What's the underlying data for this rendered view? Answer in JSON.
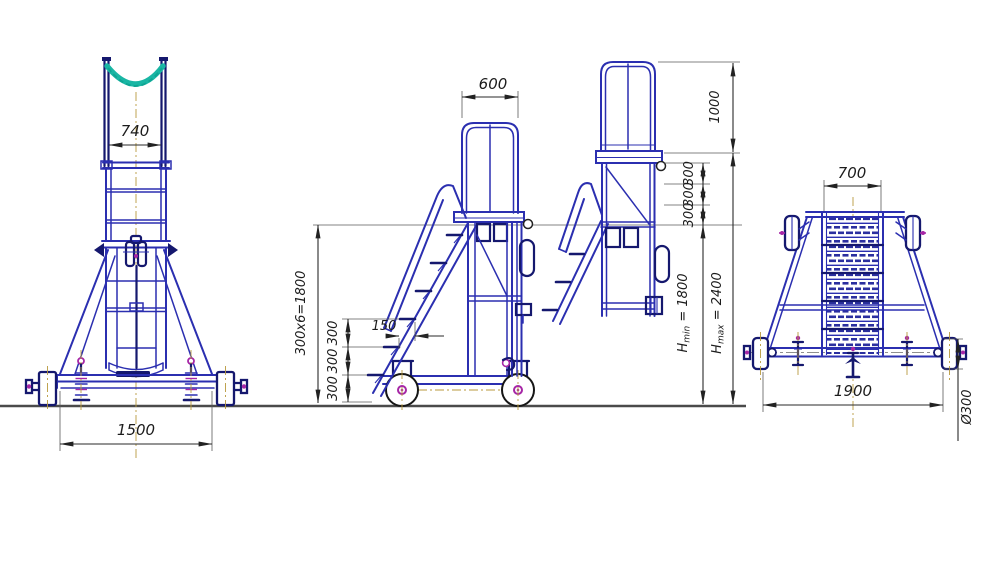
{
  "meta": {
    "description": "GOST-style dimensioned engineering drawing, three views of a mobile adjustable-height platform step-ladder with top cradle"
  },
  "colors": {
    "line_blue": "#2b2fb0",
    "line_navy": "#15186e",
    "accent_teal": "#19b6a4",
    "hub_magenta": "#a626a6",
    "centerline_olive": "#b99a3e",
    "dimension": "#1c1c1c",
    "ground": "#4a4a4a"
  },
  "views": {
    "front": {
      "dims": {
        "mast_width": "740",
        "wheel_track": "1500"
      }
    },
    "side_lowered": {
      "dims": {
        "guard_width": "600",
        "rise_total": "300x6=1800",
        "tread_depth": "150",
        "rises": [
          "300",
          "300",
          "300"
        ]
      }
    },
    "side_raised": {
      "dims": {
        "guard_height": "1000",
        "adjust_steps": [
          "300",
          "300",
          "300"
        ],
        "h_min": {
          "sym": "H",
          "sub": "min",
          "eq": " = 1800"
        },
        "h_max": {
          "sym": "H",
          "sub": "max",
          "eq": " = 2400"
        }
      }
    },
    "rear": {
      "dims": {
        "ladder_width": "700",
        "base_width": "1900",
        "wheel_diameter": "Ø300"
      }
    }
  }
}
